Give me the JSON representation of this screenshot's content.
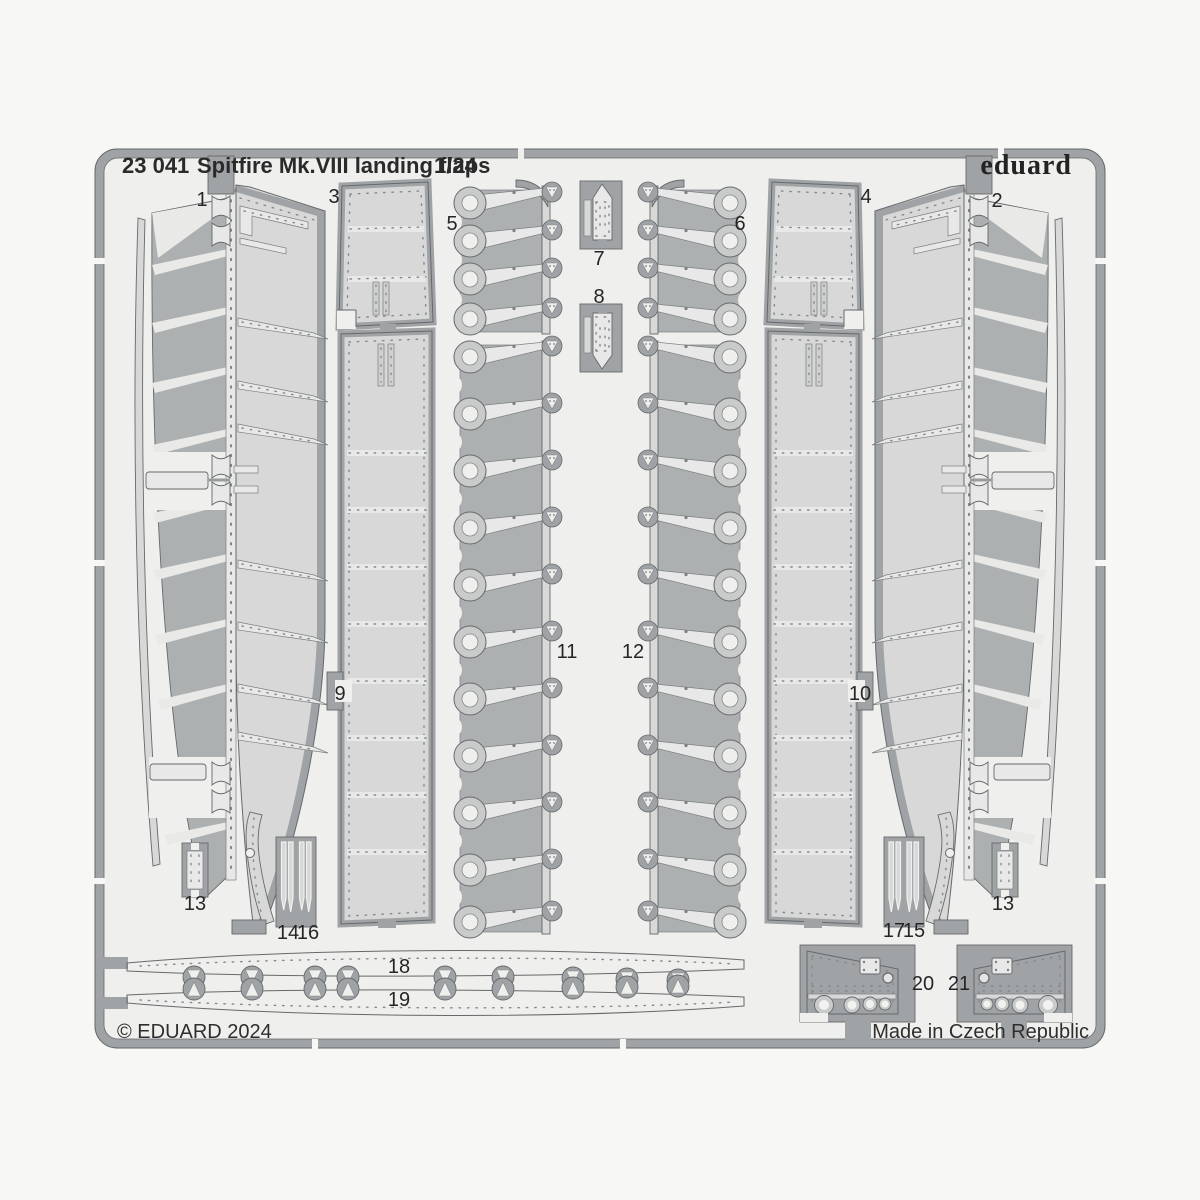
{
  "header": {
    "catalog_number": "23 041",
    "title": "Spitfire Mk.VIII landing flaps",
    "scale": "1/24",
    "brand": "eduard"
  },
  "footer": {
    "copyright": "© EDUARD 2024",
    "made_in": "Made in Czech Republic"
  },
  "sheet": {
    "description": "Photo-etched metal fret with numbered landing flap parts",
    "part_numbers": [
      "1",
      "2",
      "3",
      "4",
      "5",
      "6",
      "7",
      "8",
      "9",
      "10",
      "11",
      "12",
      "13",
      "14",
      "15",
      "16",
      "17",
      "18",
      "19",
      "20",
      "21"
    ]
  },
  "labels": [
    "1",
    "2",
    "3",
    "4",
    "5",
    "6",
    "7",
    "8",
    "9",
    "10",
    "11",
    "12",
    "13",
    "13",
    "14",
    "16",
    "17",
    "15",
    "18",
    "19",
    "20",
    "21"
  ],
  "colors": {
    "page_background": "#f7f7f5",
    "fret_interior": "#efefed",
    "fret_rail_gray": "#a0a3a5",
    "part_dark_gray": "#adb0b1",
    "part_light_gray": "#d7d8d7",
    "outline": "#66696b",
    "text": "#262626"
  }
}
